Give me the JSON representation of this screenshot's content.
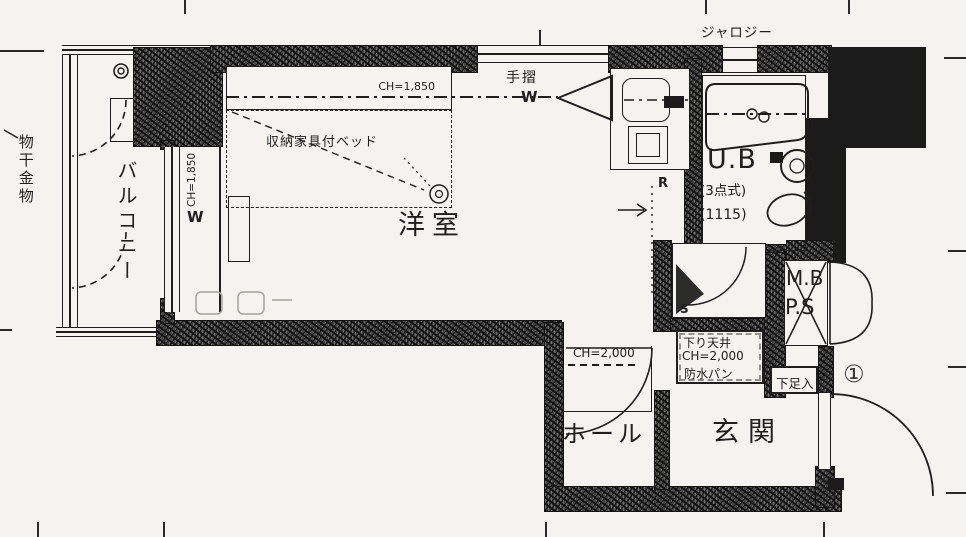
{
  "colors": {
    "ink": "#1e1e1e",
    "paper": "#f4f3f0",
    "wall_hatch": "#474747"
  },
  "labels": {
    "laundry_hardware": "物干金物",
    "balcony": "バルコニー",
    "balcony_window_ch": "CH=1,850",
    "balcony_window_w": "W",
    "bed_ch": "CH=1,850",
    "bed": "収納家具付ベッド",
    "western_room": "洋室",
    "handrail": "手摺",
    "handrail_w": "W",
    "jalousie": "ジャロジー",
    "unit_bath": "U.B",
    "unit_bath_type": "(3点式)",
    "unit_bath_size": "(1115)",
    "refrigerator": "R",
    "storage": "S",
    "hall_ch": "CH=2,000",
    "lowered_ceiling": "下り天井",
    "lowered_ceiling_ch": "CH=2,000",
    "waterproof_pan": "防水パン",
    "meter_box": "M.B",
    "pipe_space": "P.S",
    "shoe_cabinet": "下足入",
    "hall": "ホール",
    "entrance": "玄関",
    "entrance_door_mark": "①"
  }
}
